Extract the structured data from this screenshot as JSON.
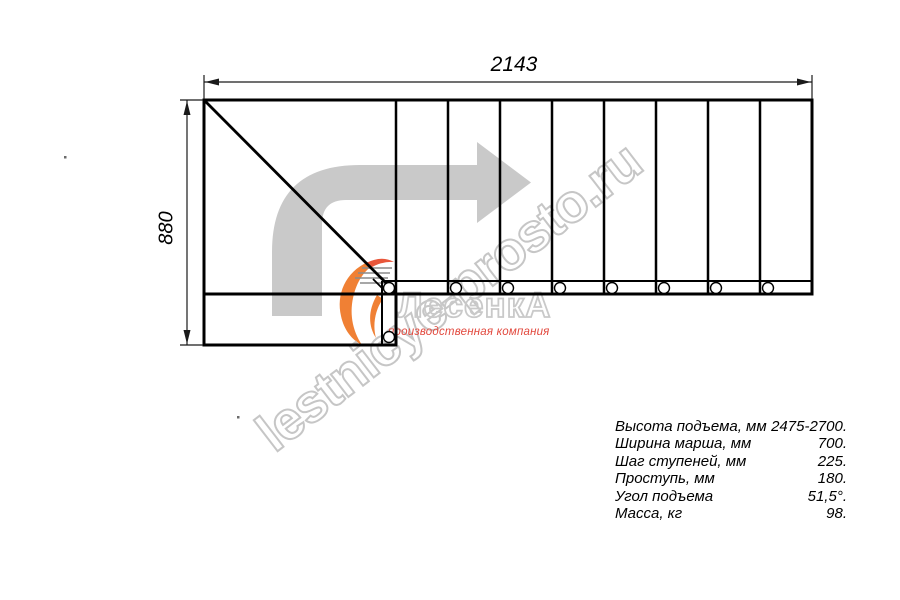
{
  "drawing": {
    "top_dimension": "2143",
    "left_dimension": "880"
  },
  "specs": {
    "rows": [
      {
        "label": "Высота подъема, мм",
        "value": "2475-2700."
      },
      {
        "label": "Ширина марша, мм",
        "value": "700."
      },
      {
        "label": "Шаг ступеней, мм",
        "value": "225."
      },
      {
        "label": "Проступь, мм",
        "value": "180."
      },
      {
        "label": "Угол подъема",
        "value": "51,5°."
      },
      {
        "label": "Масса, кг",
        "value": "98."
      }
    ]
  },
  "watermark": {
    "site": "lestnicye-prosto.ru",
    "logo": "ЛесенкА",
    "tagline": "производственная компания"
  },
  "icons": {
    "direction_arrow": "turn-right-arrow-icon",
    "logo_flame": "flame-swoosh-icon"
  },
  "colors": {
    "line_black": "#000000",
    "arrow_gray": "#c9c9c9",
    "watermark_gray": "#c6c6c6",
    "tagline_red": "#e2483d",
    "logo_orange": "#f08034"
  }
}
